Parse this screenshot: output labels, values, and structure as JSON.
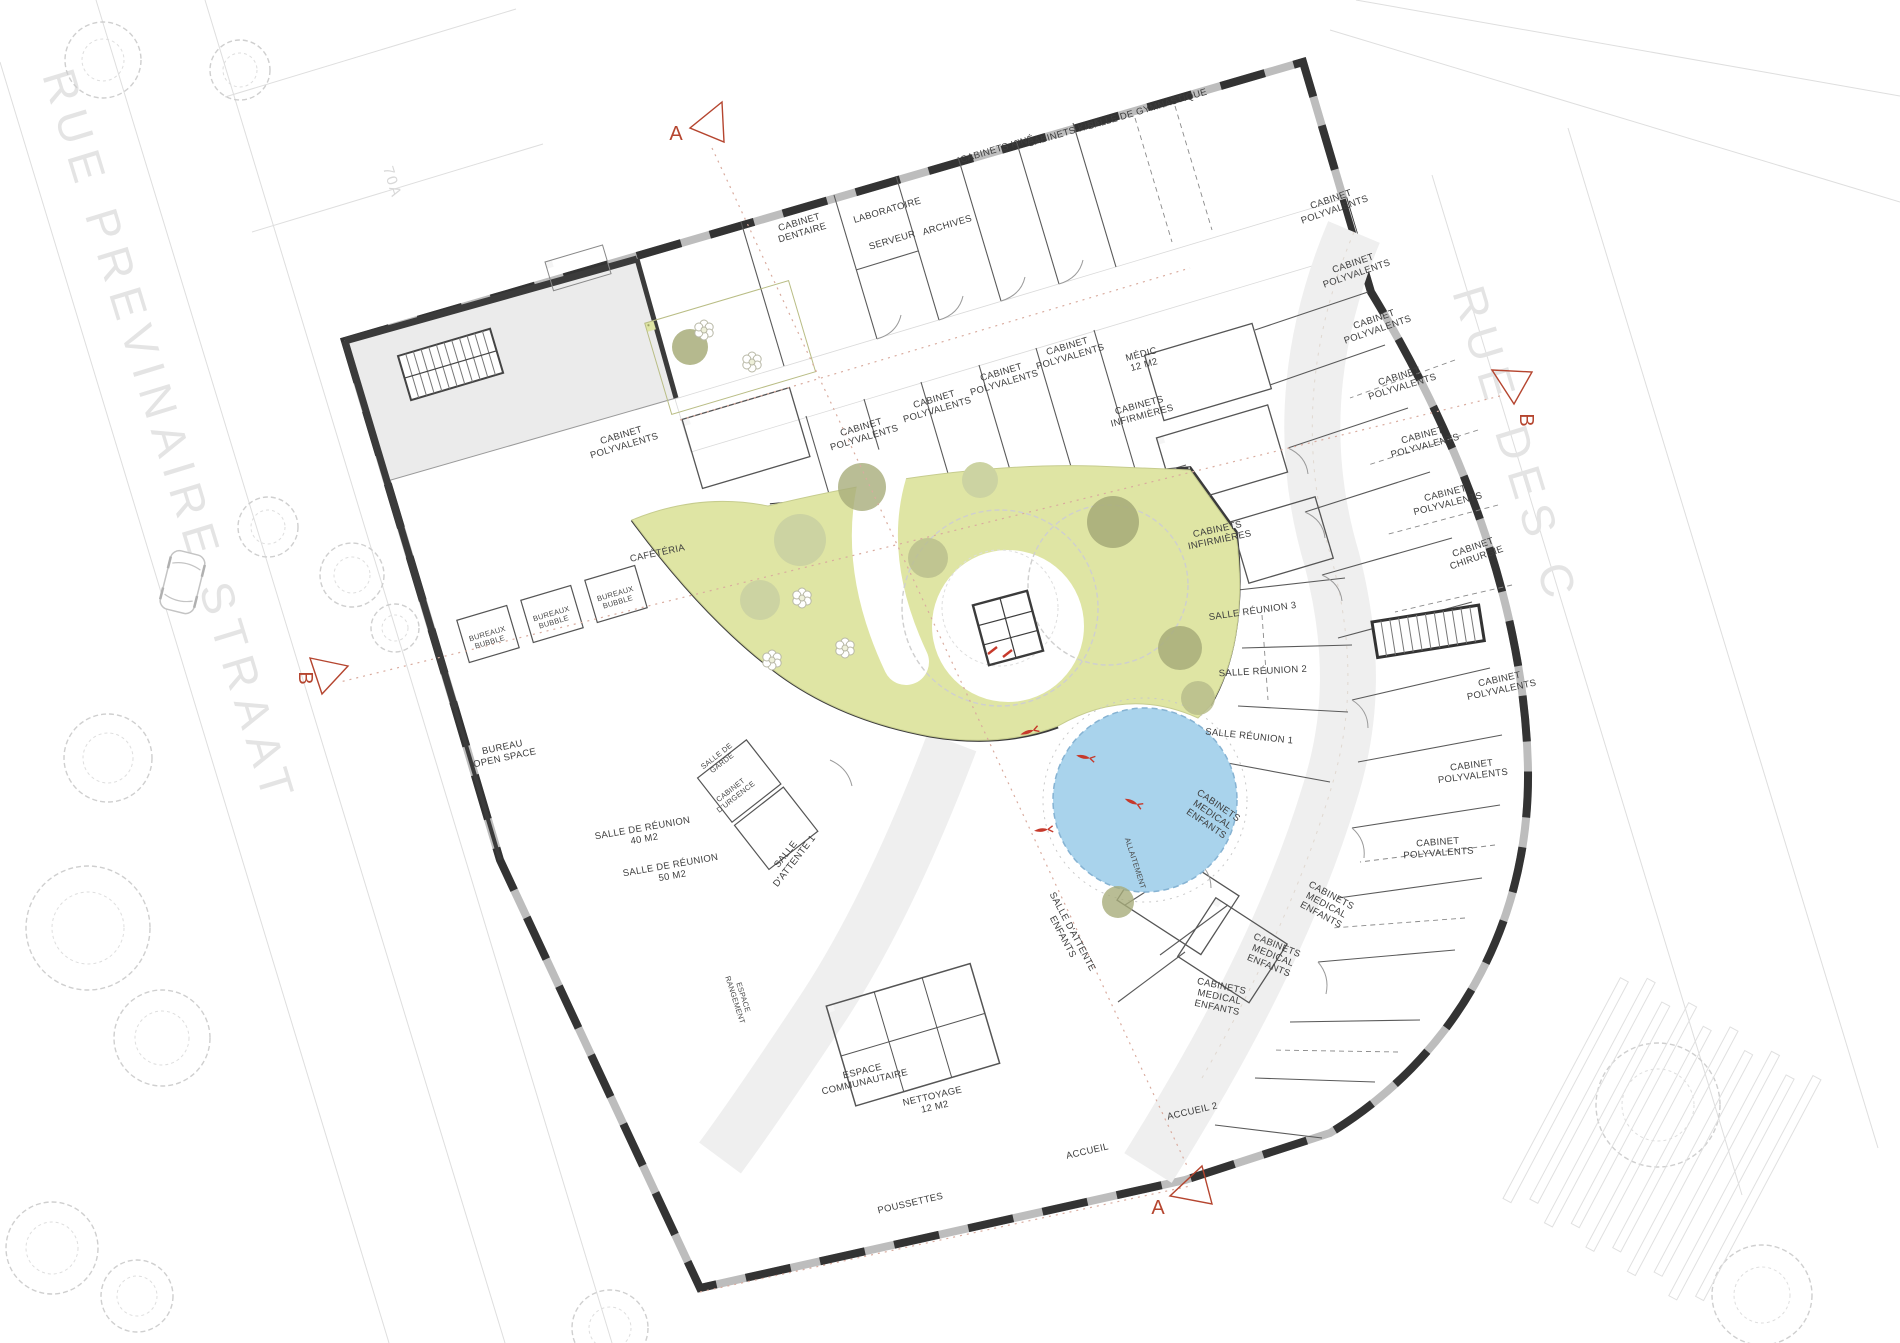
{
  "site": {
    "street_left": "RUE PREVINAIRE STRAAT",
    "street_right": "RUE DES C",
    "parcel_number": "70A"
  },
  "section_markers": {
    "a": "A",
    "b": "B"
  },
  "colors": {
    "wall_dark": "#3b3b3b",
    "courtyard_green": "#dfe5a4",
    "pond_blue": "#a9d3ec",
    "accent_red": "#b5452f",
    "corridor_gray": "#f0f0f0",
    "room_gray": "#ebebeb",
    "tree_olive": "#a8ad7a",
    "tree_light": "#ccd3a2"
  },
  "rooms": {
    "cabinet_dentaire": [
      "CABINET",
      "DENTAIRE"
    ],
    "laboratoire": "LABORATOIRE",
    "serveur": "SERVEUR",
    "archives": "ARCHIVES",
    "cabinets_kine": "CABINETS KINÉ",
    "salle_de_gymnastique": "SALLE DE GYMNASTIQUE",
    "cabinet_polyvalents": [
      "CABINET",
      "POLYVALENTS"
    ],
    "medic": [
      "MÉDIC",
      "12 M2"
    ],
    "cabinets_infirmieres": [
      "CABINETS",
      "INFIRMIÈRES"
    ],
    "cabinet_chirurgie": [
      "CABINET",
      "CHIRURGIE"
    ],
    "salle_reunion_3": "SALLE RÉUNION 3",
    "salle_reunion_2": "SALLE RÉUNION 2",
    "salle_reunion_1": "SALLE RÉUNION 1",
    "cabinets_medical_enfants": [
      "CABINETS",
      "MEDICAL",
      "ENFANTS"
    ],
    "salle_d_attente_enfants": [
      "SALLE D'ATTENTE",
      "ENFANTS"
    ],
    "allaitement": "ALLAITEMENT",
    "salle_de_garde": [
      "SALLE DE",
      "GARDE"
    ],
    "cabinet_d_urgence": [
      "CABINET",
      "D'URGENCE"
    ],
    "salle_d_attente_1": [
      "SALLE",
      "D'ATTENTE 1"
    ],
    "salle_de_reunion_40": [
      "SALLE DE RÉUNION",
      "40 M2"
    ],
    "salle_de_reunion_50": [
      "SALLE DE RÉUNION",
      "50 M2"
    ],
    "bureau_open_space": [
      "BUREAU",
      "OPEN SPACE"
    ],
    "bureaux_bubble": [
      "BUREAUX",
      "BUBBLE"
    ],
    "cafeteria": "CAFÉTÉRIA",
    "espace_communautaire": [
      "ESPACE",
      "COMMUNAUTAIRE"
    ],
    "nettoyage": [
      "NETTOYAGE",
      "12 M2"
    ],
    "espace_rangement": [
      "ESPACE",
      "RANGEMENT"
    ],
    "poussettes": "POUSSETTES",
    "accueil": "ACCUEIL",
    "accueil_2": "ACCUEIL 2"
  }
}
